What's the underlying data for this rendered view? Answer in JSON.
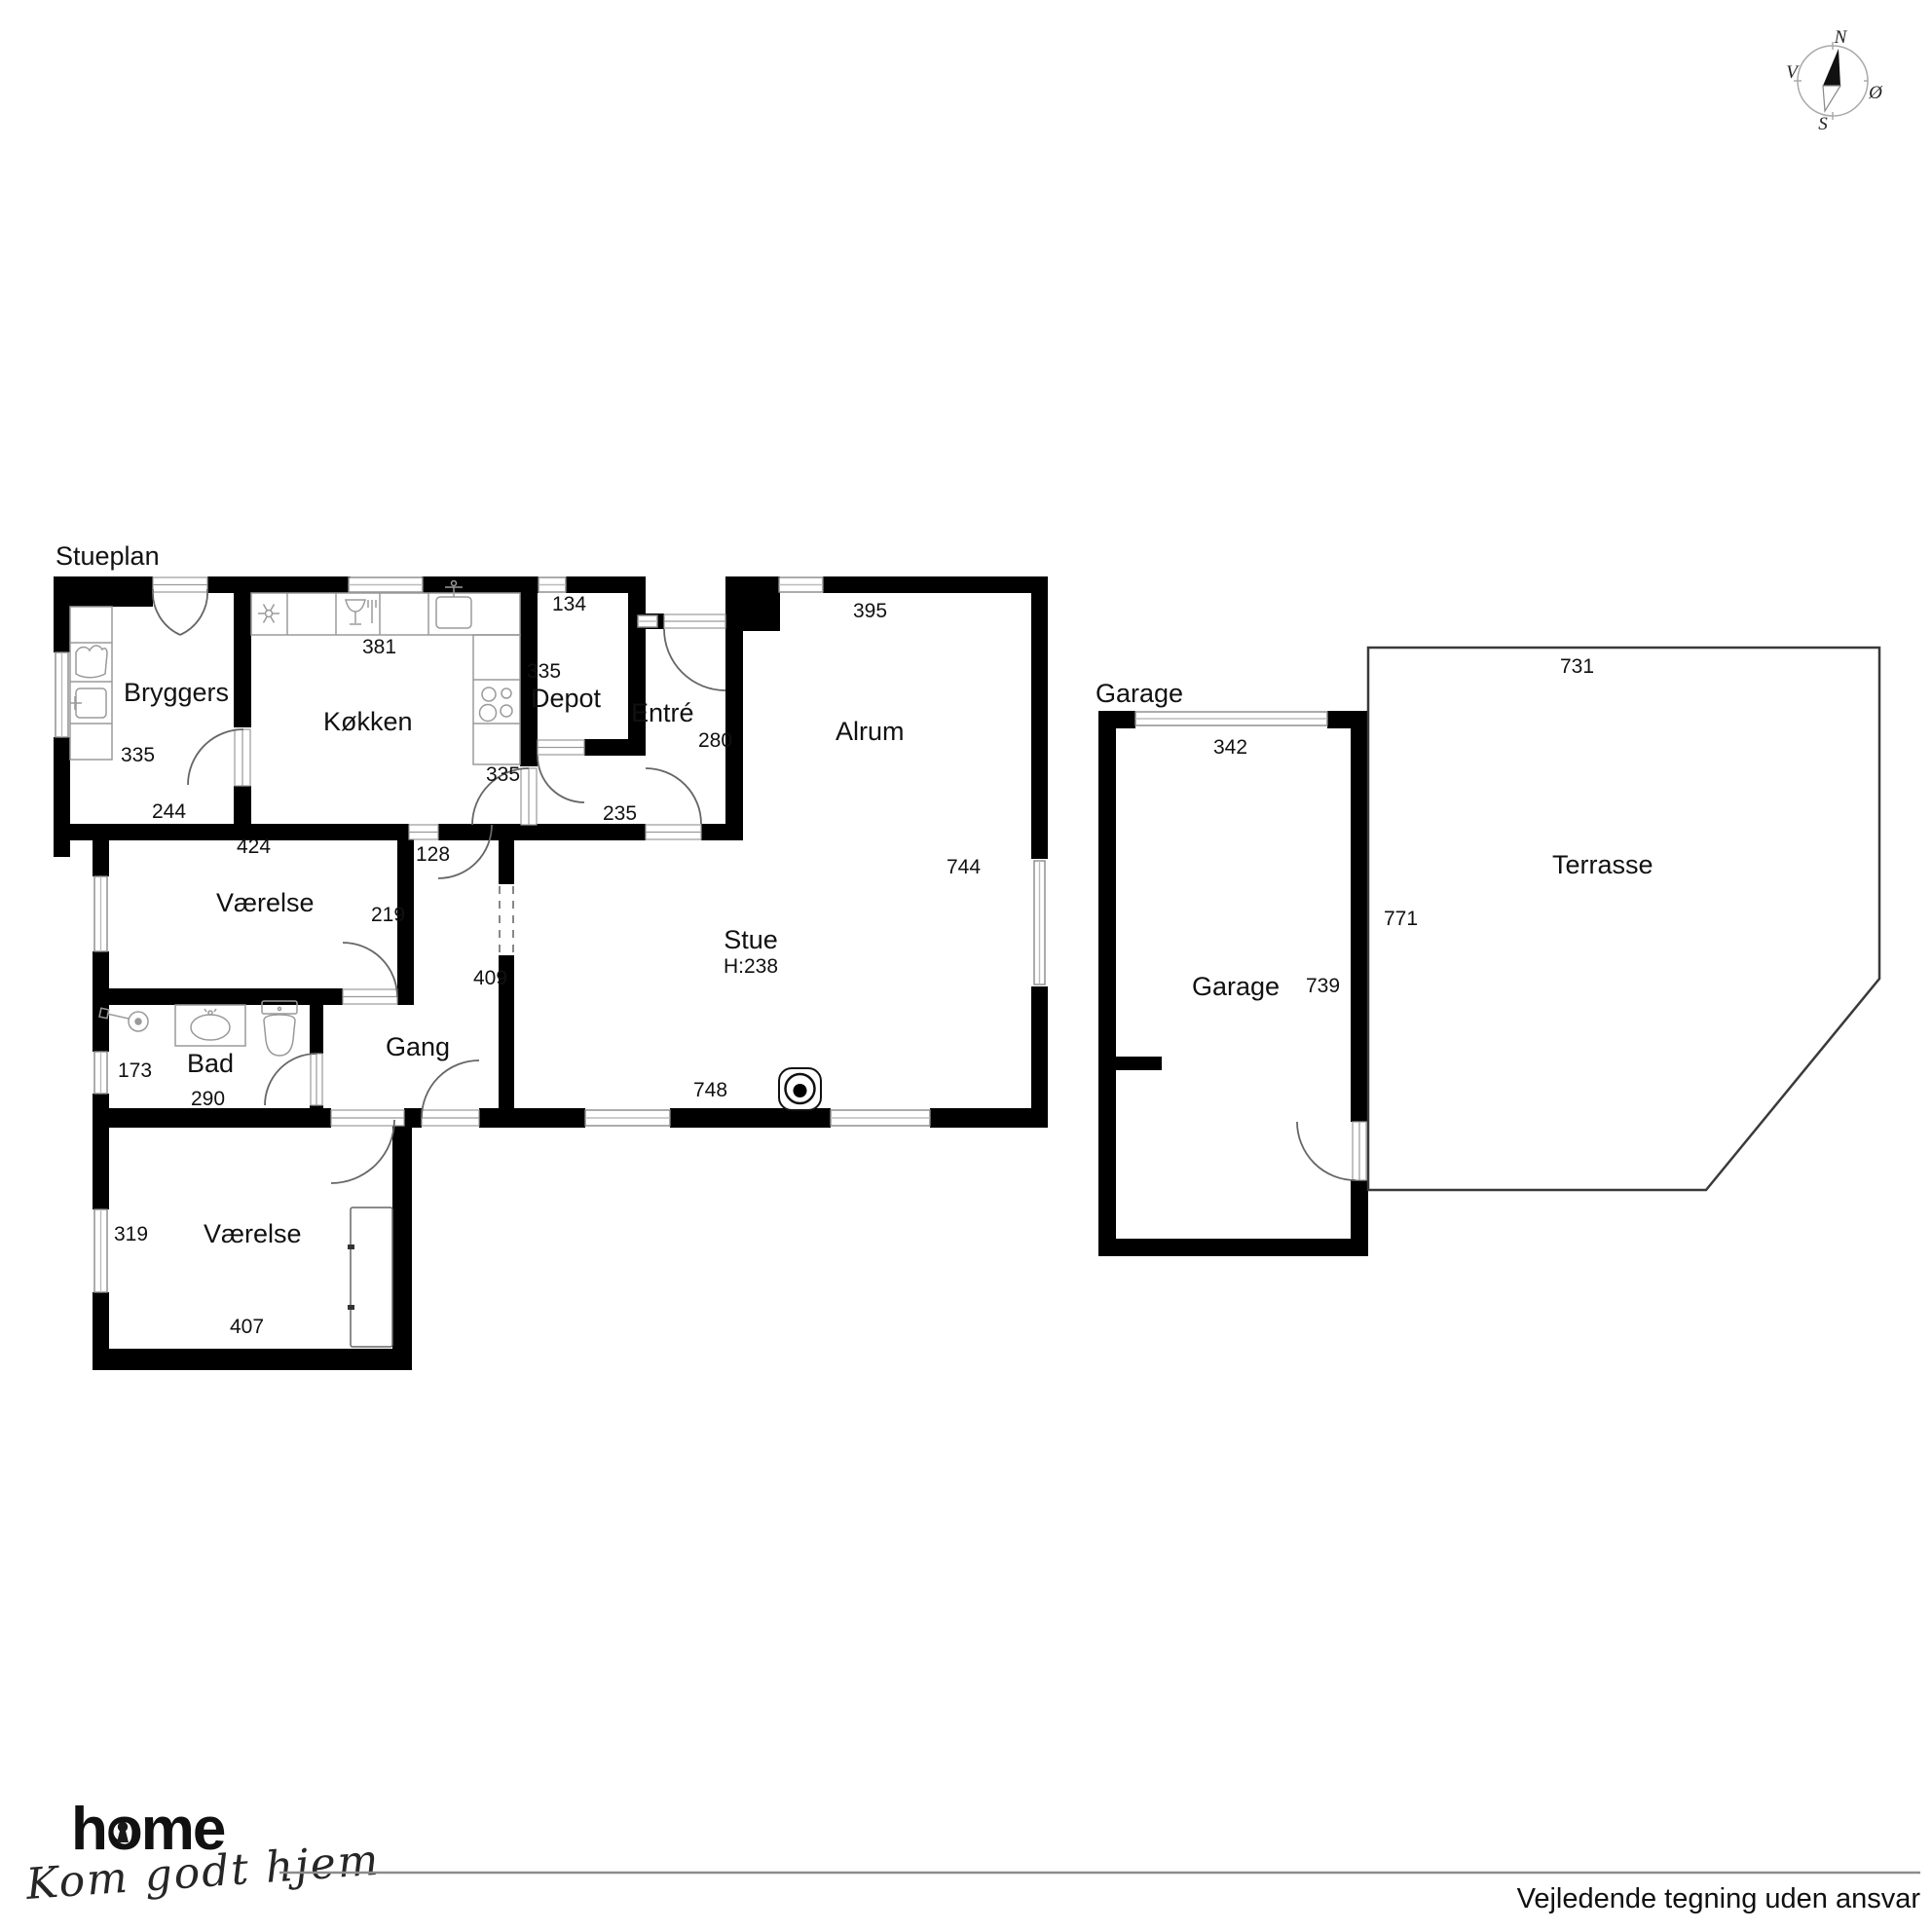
{
  "titles": {
    "floor": "Stueplan",
    "garage_section": "Garage"
  },
  "rooms": {
    "bryggers": {
      "name": "Bryggers",
      "dim_left": "335",
      "dim_bottom": "244"
    },
    "kokken": {
      "name": "Køkken",
      "dim_top": "381",
      "dim_door": "335"
    },
    "depot": {
      "name": "Depot",
      "dim_top": "134",
      "dim_left": "335"
    },
    "entre": {
      "name": "Entré",
      "dim_right": "280",
      "dim_bottom": "235"
    },
    "alrum": {
      "name": "Alrum",
      "dim_top": "395",
      "dim_right": "744"
    },
    "stue": {
      "name": "Stue",
      "ceiling": "H:238",
      "dim_bottom": "748"
    },
    "vaerelse1": {
      "name": "Værelse",
      "dim_top": "424",
      "dim_right": "219"
    },
    "gang": {
      "name": "Gang",
      "dim_right": "409",
      "dim_door": "128"
    },
    "bad": {
      "name": "Bad",
      "dim_left": "173",
      "dim_bottom": "290"
    },
    "vaerelse2": {
      "name": "Værelse",
      "dim_left": "319",
      "dim_bottom": "407"
    },
    "garage": {
      "name": "Garage",
      "dim_top": "342",
      "dim_width": "739",
      "dim_right": "771"
    },
    "terrasse": {
      "name": "Terrasse",
      "dim_top": "731"
    }
  },
  "compass": {
    "north": "N",
    "south": "S",
    "west": "V",
    "east": "Ø"
  },
  "branding": {
    "logo": "home",
    "slogan": "Kom godt hjem"
  },
  "footer": {
    "disclaimer": "Vejledende tegning uden ansvar"
  },
  "colors": {
    "wall": "#000000",
    "fixture": "#9a9a9a",
    "accent_red": "#e4202c"
  }
}
